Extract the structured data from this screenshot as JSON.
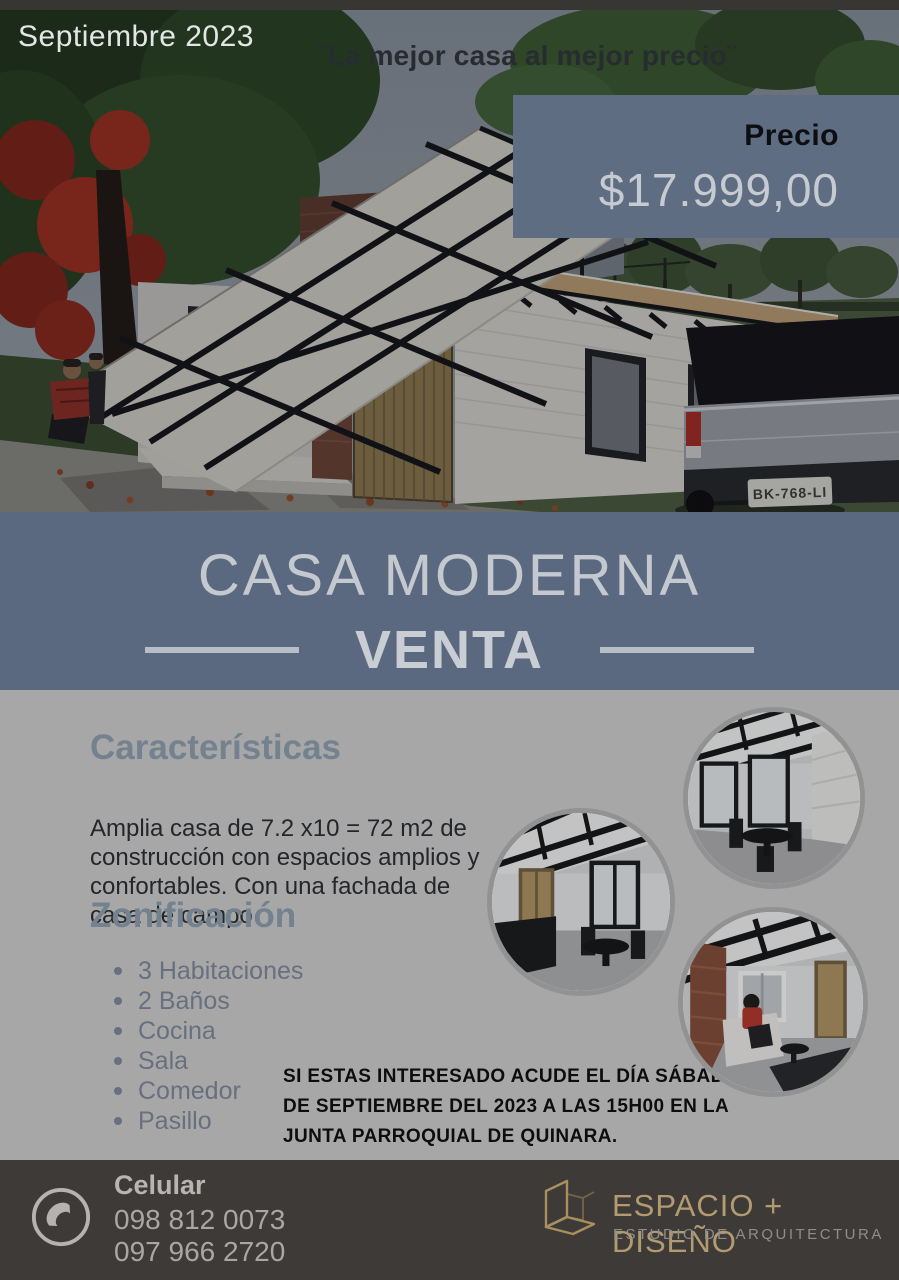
{
  "hero": {
    "date_label": "Septiembre 2023",
    "tagline": "¨La mejor casa al mejor precio¨",
    "price": {
      "label": "Precio",
      "amount": "$17.999,00"
    },
    "license_plate": "BK-768-LI"
  },
  "title_band": {
    "title": "CASA MODERNA",
    "subtitle": "VENTA"
  },
  "features": {
    "heading": "Características",
    "body": "Amplia casa de 7.2 x10 = 72 m2 de construcción con espacios amplios y confortables. Con una fachada de casa de campo"
  },
  "zoning": {
    "heading": "Zonificación",
    "items": [
      "3 Habitaciones",
      "2 Baños",
      "Cocina",
      "Sala",
      "Comedor",
      "Pasillo"
    ]
  },
  "invitation": {
    "lines": [
      "SI ESTAS INTERESADO ACUDE EL DÍA SÁBADO 2",
      "DE SEPTIEMBRE DEL 2023 A LAS 15H00 EN LA",
      "JUNTA PARROQUIAL DE QUINARA."
    ]
  },
  "footer": {
    "phone": {
      "icon": "phone-icon",
      "label": "Celular",
      "numbers": [
        "098 812 0073",
        "097 966 2720"
      ]
    },
    "brand": {
      "icon": "cube-outline-icon",
      "name": "ESPACIO + DISEÑO",
      "subtitle": "ESTUDIO DE ARQUITECTURA"
    }
  },
  "colors": {
    "band": "#5b6980",
    "price_box": "#5f6d83",
    "content_bg": "#a7a7a7",
    "footer_bg": "#3e3a37",
    "heading": "#74818f",
    "brand_gold": "#b29b70",
    "light_text": "#c6cad1",
    "invite_text": "#0d0d0d"
  }
}
